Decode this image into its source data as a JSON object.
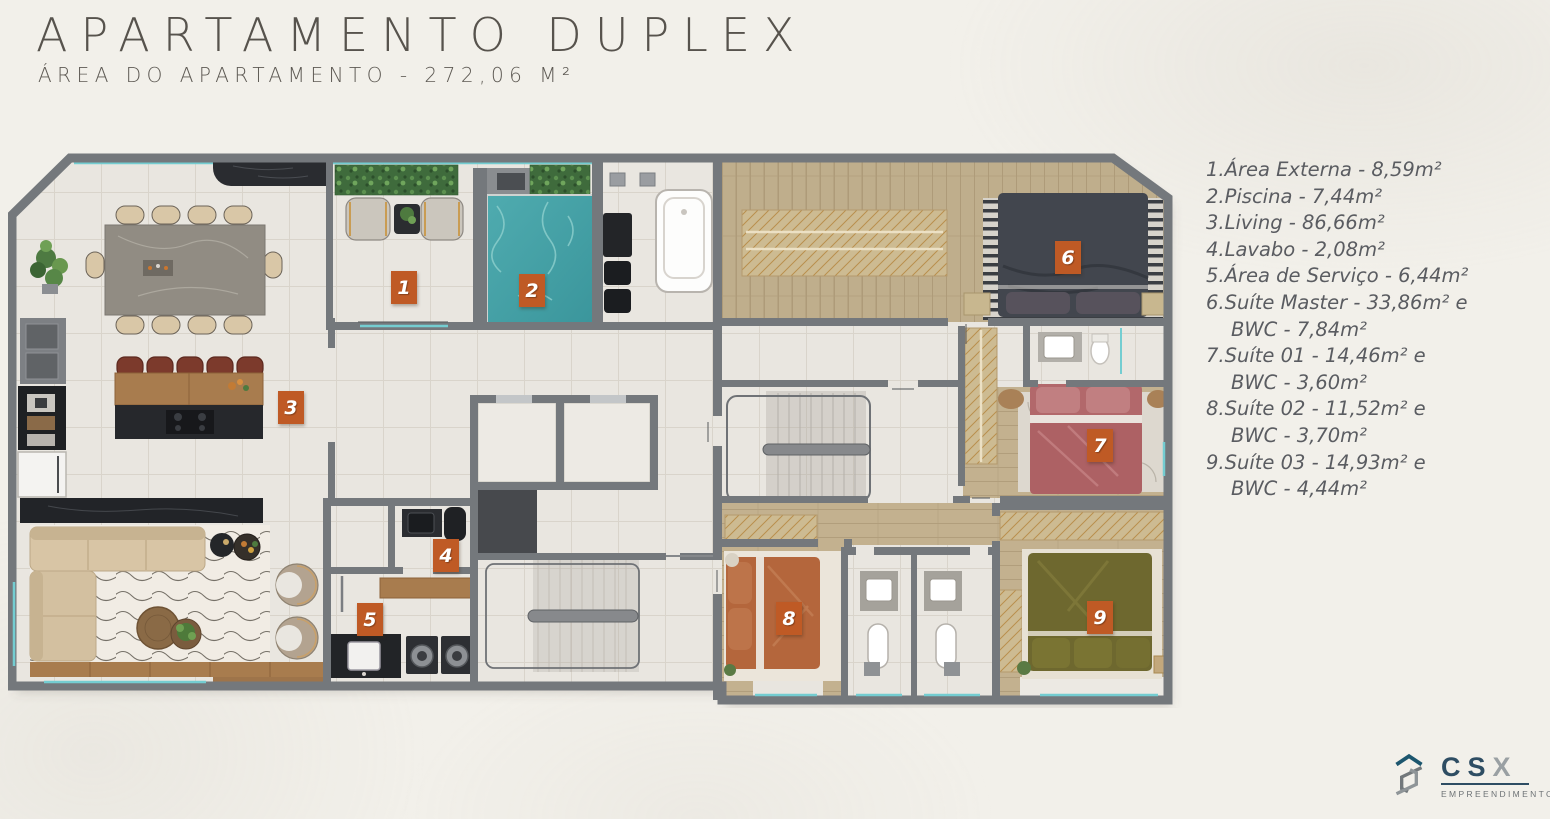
{
  "header": {
    "title": "APARTAMENTO DUPLEX",
    "subtitle": "ÁREA DO APARTAMENTO - 272,06 M²"
  },
  "legend": {
    "items": [
      {
        "lines": [
          "1.Área Externa - 8,59m²"
        ]
      },
      {
        "lines": [
          "2.Piscina - 7,44m²"
        ]
      },
      {
        "lines": [
          "3.Living - 86,66m²"
        ]
      },
      {
        "lines": [
          "4.Lavabo - 2,08m²"
        ]
      },
      {
        "lines": [
          "5.Área de Serviço - 6,44m²"
        ]
      },
      {
        "lines": [
          "6.Suíte Master - 33,86m² e",
          "BWC - 7,84m²"
        ]
      },
      {
        "lines": [
          "7.Suíte 01 - 14,46m² e",
          "BWC - 3,60m²"
        ]
      },
      {
        "lines": [
          "8.Suíte 02 - 11,52m² e",
          "BWC - 3,70m²"
        ]
      },
      {
        "lines": [
          "9.Suíte 03 - 14,93m² e",
          "BWC - 4,44m²"
        ]
      }
    ]
  },
  "plan": {
    "badges": [
      {
        "num": "1"
      },
      {
        "num": "2"
      },
      {
        "num": "3"
      },
      {
        "num": "4"
      },
      {
        "num": "5"
      },
      {
        "num": "6"
      },
      {
        "num": "7"
      },
      {
        "num": "8"
      },
      {
        "num": "9"
      }
    ]
  },
  "logo": {
    "brand_cs": "CS",
    "brand_x": "X",
    "tagline": "EMPREENDIMENTOS"
  },
  "colors": {
    "badge_orange": "#bf5a25",
    "window_teal": "#74cdd1",
    "wall_gray": "#74787c",
    "pool_teal": "#44a1a6",
    "tile_floor": "#e9e6e0",
    "wood_floor": "#c3b18f"
  }
}
